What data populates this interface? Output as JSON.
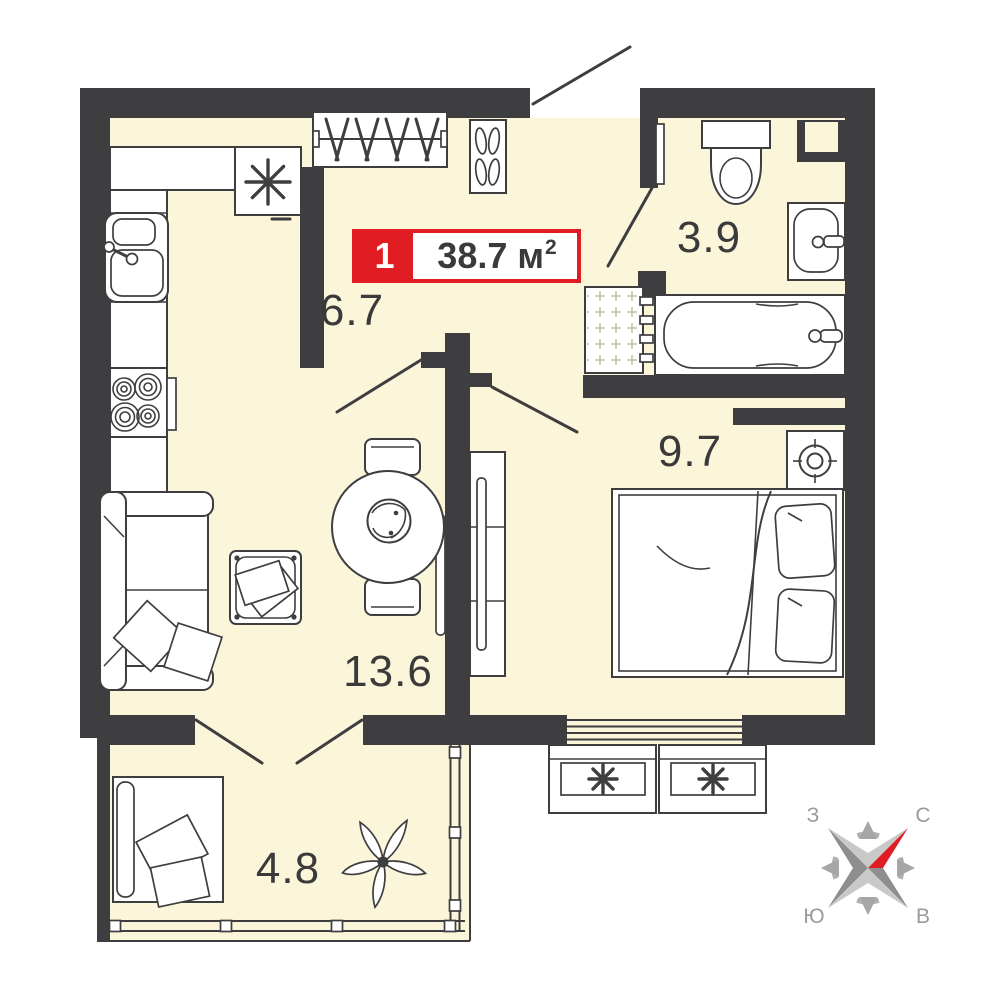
{
  "badge": {
    "rooms_count": "1",
    "area_text": "38.7 м",
    "area_sup": "2"
  },
  "room_labels": {
    "hallway": "6.7",
    "bathroom": "3.9",
    "bedroom": "9.7",
    "living": "13.6",
    "balcony": "4.8"
  },
  "compass": {
    "west": "З",
    "north": "С",
    "south": "Ю",
    "east": "В"
  },
  "colors": {
    "floor": "#FBF6DA",
    "walls": "#3E3E40",
    "accent_red": "#E11D24",
    "furniture_line": "#3E3E40",
    "compass_gray_light": "#C9C9C9",
    "compass_gray_dark": "#8E8E8E",
    "compass_letter_gray": "#9B9B9B",
    "label_text": "#3A3A3A"
  }
}
